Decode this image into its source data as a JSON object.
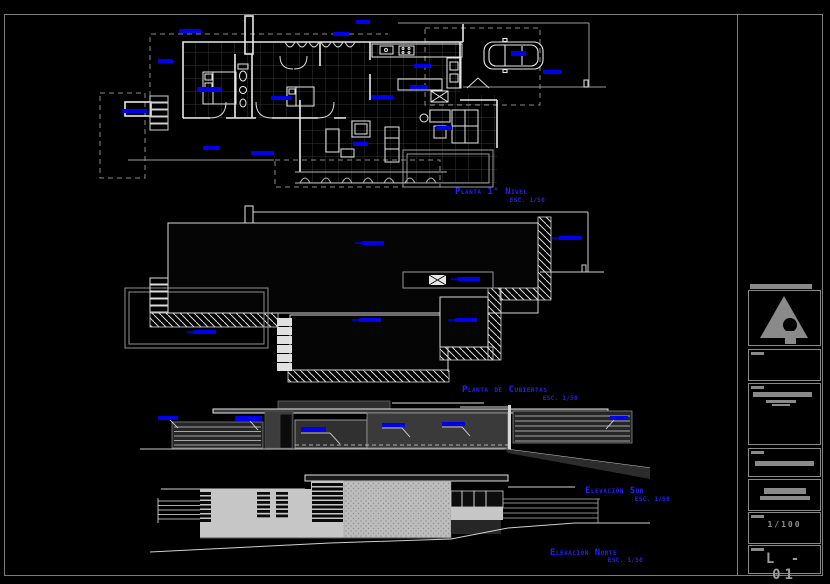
{
  "sheet": {
    "background_color": "#000000",
    "frame_color": "#7d7d7d",
    "wall_color": "#e8e8e8",
    "annotation_blue": "#0000ee",
    "title_blue": "#2020ff",
    "views": [
      {
        "title": "Planta 1° Nivel",
        "scale": "ESC. 1/50"
      },
      {
        "title": "Planta de Cubiertas",
        "scale": "ESC. 1/50"
      },
      {
        "title": "Elevación Sur",
        "scale": "ESC. 1/50"
      },
      {
        "title": "Elevación Norte",
        "scale": "ESC. 1/50"
      }
    ],
    "title_block": {
      "logo_icon": "architect-monogram-icon",
      "scale_value": "1/100",
      "sheet_number": "L - 01"
    }
  }
}
